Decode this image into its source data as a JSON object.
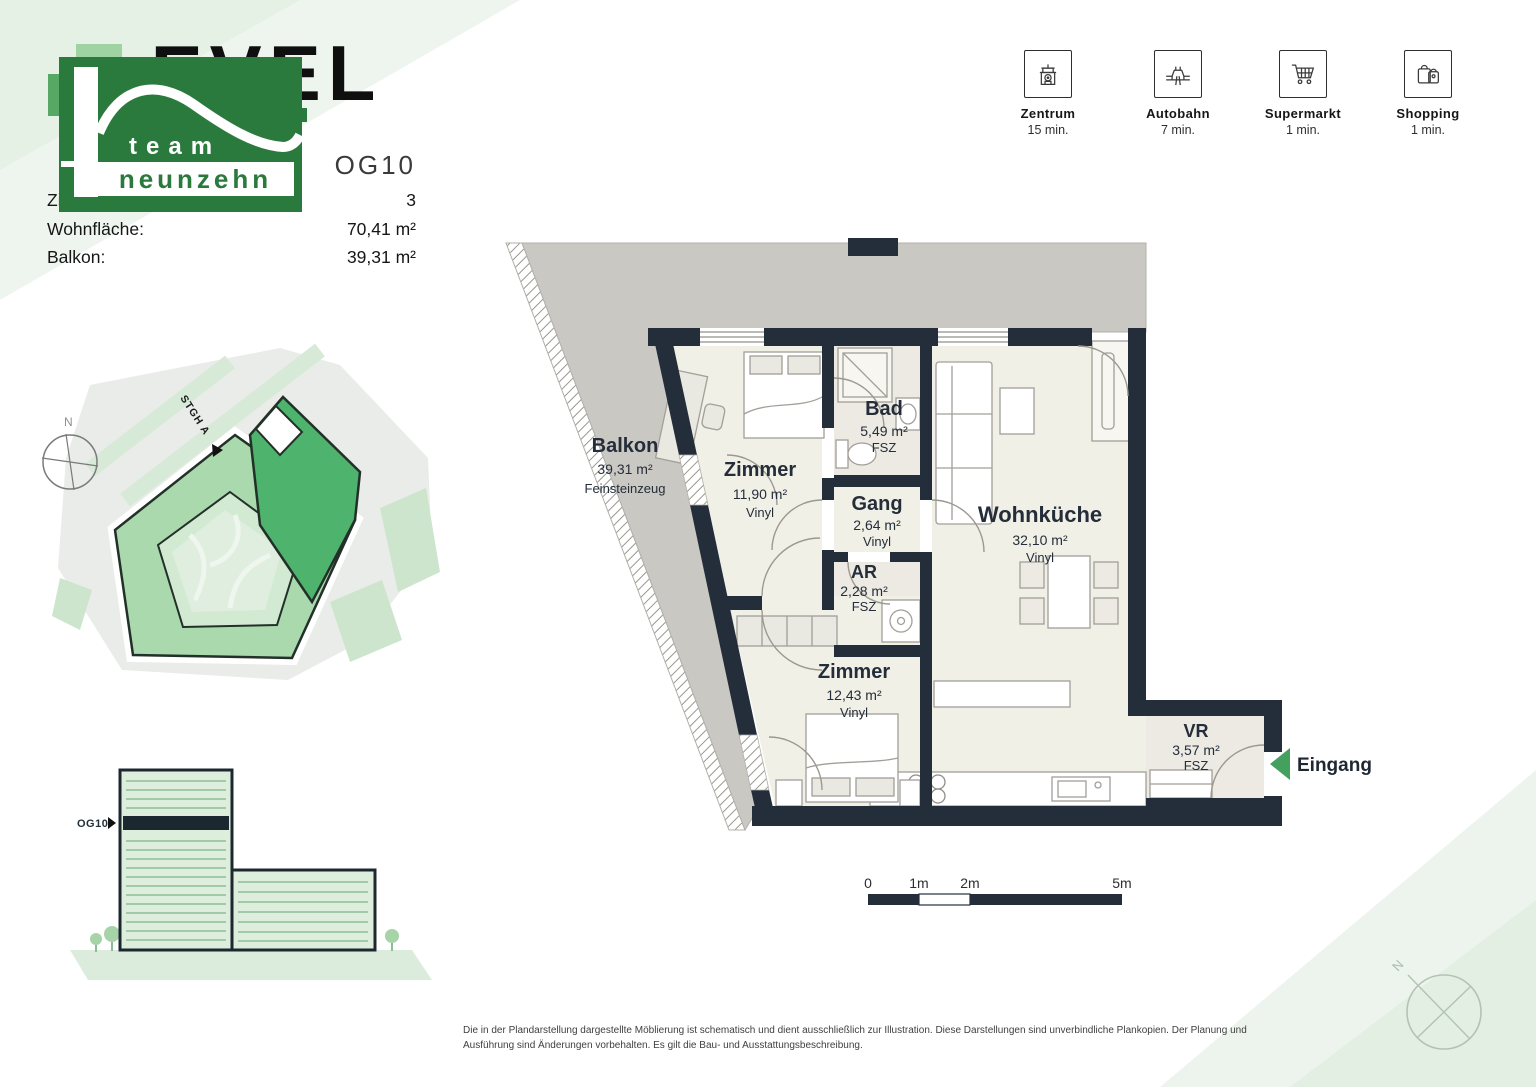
{
  "header": {
    "title": "LEVEL",
    "unit_code": "OG10",
    "rows": [
      {
        "label": "Zimmer:",
        "value": "3"
      },
      {
        "label": "Wohnfläche:",
        "value": "70,41 m²"
      },
      {
        "label": "Balkon:",
        "value": "39,31 m²"
      }
    ]
  },
  "logo": {
    "line1": "team",
    "line2": "neunzehn"
  },
  "quick_facts": [
    {
      "icon": "town-hall-icon",
      "label": "Zentrum",
      "time": "15 min."
    },
    {
      "icon": "highway-icon",
      "label": "Autobahn",
      "time": "7 min."
    },
    {
      "icon": "cart-icon",
      "label": "Supermarkt",
      "time": "1 min."
    },
    {
      "icon": "shopping-bags-icon",
      "label": "Shopping",
      "time": "1 min."
    }
  ],
  "floor_plan": {
    "rooms": [
      {
        "name": "Balkon",
        "area": "39,31 m²",
        "floor": "Feinsteinzeug"
      },
      {
        "name": "Zimmer",
        "area": "11,90 m²",
        "floor": "Vinyl"
      },
      {
        "name": "Bad",
        "area": "5,49 m²",
        "floor": "FSZ"
      },
      {
        "name": "Gang",
        "area": "2,64 m²",
        "floor": "Vinyl"
      },
      {
        "name": "AR",
        "area": "2,28 m²",
        "floor": "FSZ"
      },
      {
        "name": "Wohnküche",
        "area": "32,10 m²",
        "floor": "Vinyl"
      },
      {
        "name": "Zimmer",
        "area": "12,43 m²",
        "floor": "Vinyl"
      },
      {
        "name": "VR",
        "area": "3,57 m²",
        "floor": "FSZ"
      }
    ],
    "entrance_label": "Eingang",
    "scale_ticks": [
      "0",
      "1m",
      "2m",
      "5m"
    ]
  },
  "site_plan": {
    "stairs_label": "STGH A",
    "north": "N"
  },
  "elevation": {
    "floor_label": "OG10"
  },
  "footer": {
    "disclaimer": "Die in der Plandarstellung dargestellte Möblierung ist schematisch und dient ausschließlich zur Illustration. Diese Darstellungen sind unverbindliche Plankopien. Der Planung und Ausführung sind Änderungen vorbehalten. Es gilt die Bau- und Ausstattungsbeschreibung."
  },
  "colors": {
    "brand_green": "#2b7a3d",
    "unit_highlight_green": "#4eb36c",
    "wall_dark": "#242e3b",
    "balcony_gray": "#cac8c2",
    "floor_cream": "#f1f0e7",
    "entrance_arrow_green": "#44a05e"
  }
}
